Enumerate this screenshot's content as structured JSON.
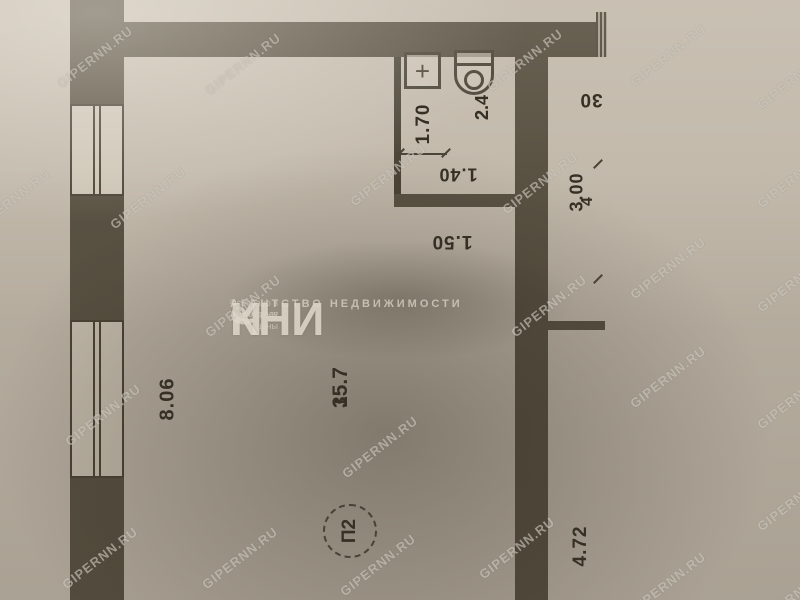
{
  "watermark": {
    "text": "GIPERNN.RU",
    "positions": [
      [
        95,
        57
      ],
      [
        243,
        64
      ],
      [
        525,
        60
      ],
      [
        668,
        55
      ],
      [
        795,
        78
      ],
      [
        12,
        200
      ],
      [
        148,
        198
      ],
      [
        388,
        175
      ],
      [
        540,
        183
      ],
      [
        795,
        177
      ],
      [
        243,
        306
      ],
      [
        549,
        306
      ],
      [
        668,
        268
      ],
      [
        795,
        281
      ],
      [
        103,
        415
      ],
      [
        380,
        447
      ],
      [
        668,
        377
      ],
      [
        795,
        398
      ],
      [
        100,
        558
      ],
      [
        240,
        558
      ],
      [
        378,
        565
      ],
      [
        517,
        548
      ],
      [
        668,
        583
      ],
      [
        795,
        500
      ],
      [
        795,
        595
      ]
    ]
  },
  "logo": {
    "agency": "АГЕНТСТВО НЕДВИЖИМОСТИ",
    "reg": "®",
    "name_parts": [
      "Ч",
      "е",
      "КНИ"
    ],
    "tagline1": "основано в 1997 году",
    "tagline2": "выгодные цены"
  },
  "plan": {
    "room_labels": [
      {
        "number": "1",
        "area": "35.7"
      },
      {
        "number": "2",
        "area": "2.4"
      }
    ],
    "dim_labels": [
      {
        "text": "1.70",
        "x": 424,
        "y": 124,
        "rot": -90,
        "size": 19
      },
      {
        "text": "1.40",
        "x": 458,
        "y": 174,
        "rot": 180,
        "size": 18
      },
      {
        "text": "1.50",
        "x": 452,
        "y": 241,
        "rot": 180,
        "size": 19
      },
      {
        "text": "30",
        "x": 591,
        "y": 99,
        "rot": 180,
        "size": 19
      },
      {
        "text": "3.00",
        "x": 577,
        "y": 192,
        "rot": -90,
        "size": 18
      },
      {
        "text": "4",
        "x": 588,
        "y": 201,
        "rot": -90,
        "size": 16
      },
      {
        "text": "8.06",
        "x": 168,
        "y": 399,
        "rot": -90,
        "size": 20
      },
      {
        "text": "4.72",
        "x": 581,
        "y": 546,
        "rot": -90,
        "size": 19
      }
    ],
    "stamp": {
      "text": "П2"
    },
    "fixtures": {
      "sink_symbol": "+"
    }
  },
  "colors": {
    "paper": "#c3baac",
    "wall": "#5a5243",
    "ink": "#362f24",
    "watermark": "rgba(242,237,227,0.5)"
  }
}
